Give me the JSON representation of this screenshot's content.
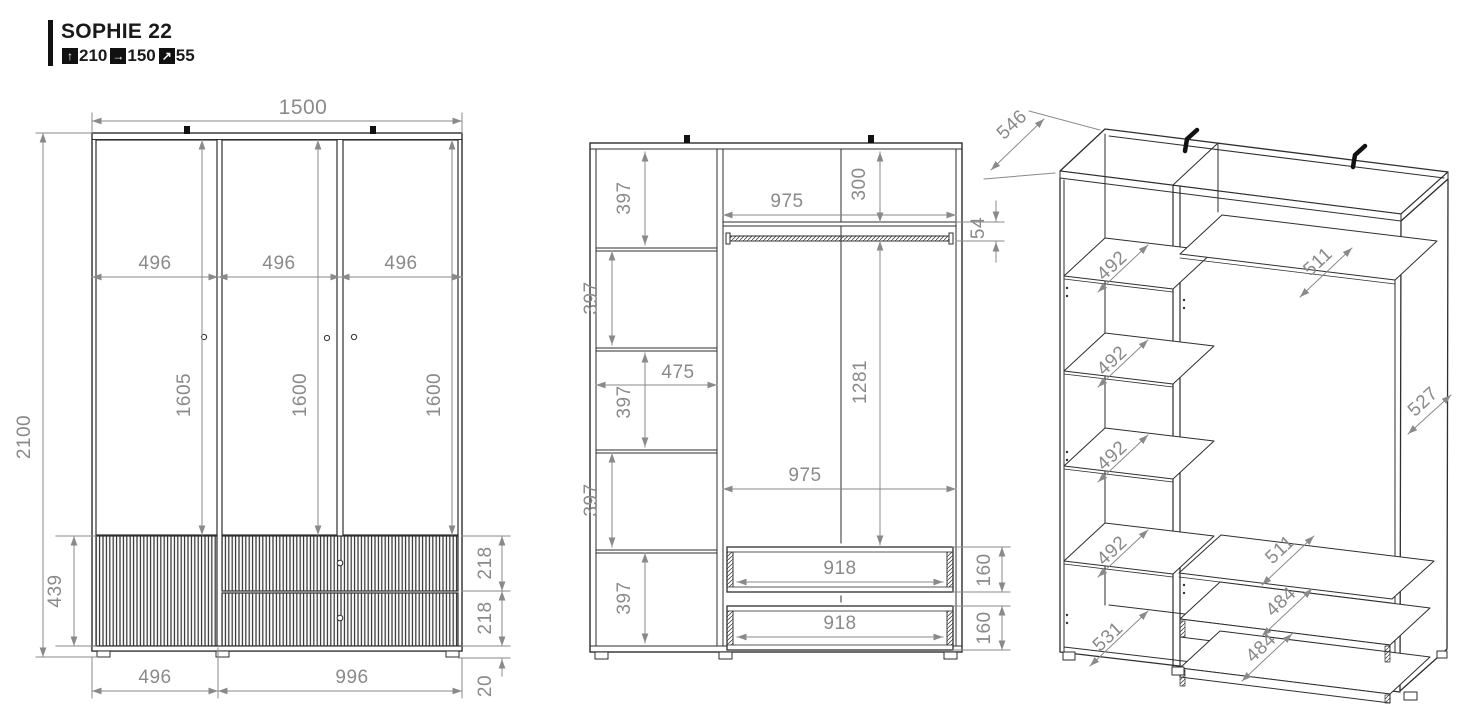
{
  "header": {
    "title": "SOPHIE 22",
    "spec": {
      "height": {
        "icon": "arrow-up",
        "value": "210"
      },
      "width": {
        "icon": "arrow-right",
        "value": "150"
      },
      "depth": {
        "icon": "arrow-diagonal",
        "value": "55"
      }
    }
  },
  "front_view": {
    "total_width": "1500",
    "total_height": "2100",
    "door_widths": [
      "496",
      "496",
      "496"
    ],
    "door_heights": [
      "1605",
      "1600",
      "1600"
    ],
    "base_height": "439",
    "drawer_front_heights": [
      "218",
      "218"
    ],
    "plinth_height": "20",
    "bottom_left_width": "496",
    "bottom_right_width": "996"
  },
  "internal_view": {
    "compartment_heights": [
      "397",
      "397",
      "397",
      "397",
      "397"
    ],
    "compartment_width": "475",
    "top_opening_width": "975",
    "top_shelf_drop": "300",
    "rail_height": "54",
    "hanging_height": "1281",
    "opening_width": "975",
    "drawer_widths": [
      "918",
      "918"
    ],
    "drawer_heights": [
      "160",
      "160"
    ]
  },
  "iso_view": {
    "top_depth": "546",
    "shelf_depths": [
      "492",
      "492",
      "492",
      "492"
    ],
    "bottom_shelf_depth": "531",
    "right_shelf_depths": [
      "511",
      "511"
    ],
    "drawer_depths": [
      "484",
      "484"
    ],
    "side_panel_depth": "527"
  }
}
